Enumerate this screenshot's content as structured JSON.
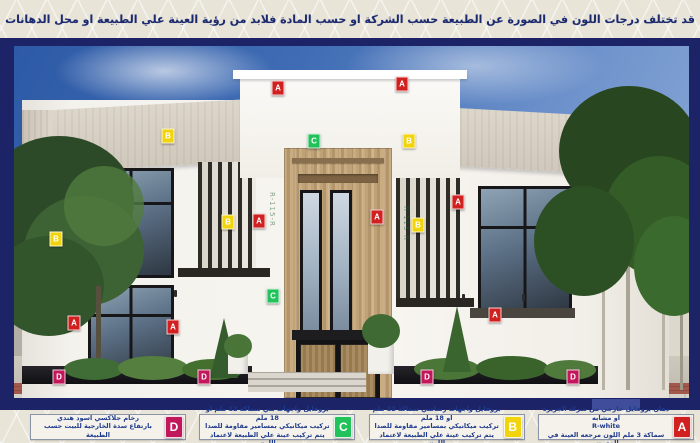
{
  "notice_bar": {
    "text": "قد تختلف درجات اللون في الصورة عن الطبيعة حسب الشركة او حسب المادة فلابد من رؤية العينة علي الطبيعة او محل الدهانات"
  },
  "colors": {
    "frame_navy": "#1d2367",
    "background_beige": "#e9e4d8",
    "marker_a_red": "#d02020",
    "marker_b_yellow": "#f2d40c",
    "marker_c_green": "#22c25a",
    "marker_d_magenta": "#c2185b"
  },
  "marker_styles": {
    "A": "#d02020",
    "B": "#f2d40c",
    "C": "#22c25a",
    "D": "#c2185b"
  },
  "markers": [
    {
      "letter": "A",
      "x": 278,
      "y": 88
    },
    {
      "letter": "A",
      "x": 402,
      "y": 84
    },
    {
      "letter": "B",
      "x": 168,
      "y": 136
    },
    {
      "letter": "C",
      "x": 314,
      "y": 141
    },
    {
      "letter": "B",
      "x": 409,
      "y": 141
    },
    {
      "letter": "A",
      "x": 458,
      "y": 202
    },
    {
      "letter": "A",
      "x": 377,
      "y": 217
    },
    {
      "letter": "B",
      "x": 418,
      "y": 225
    },
    {
      "letter": "A",
      "x": 259,
      "y": 221
    },
    {
      "letter": "B",
      "x": 228,
      "y": 222
    },
    {
      "letter": "B",
      "x": 56,
      "y": 239
    },
    {
      "letter": "A",
      "x": 74,
      "y": 323
    },
    {
      "letter": "A",
      "x": 173,
      "y": 327
    },
    {
      "letter": "C",
      "x": 273,
      "y": 296
    },
    {
      "letter": "A",
      "x": 495,
      "y": 315
    },
    {
      "letter": "D",
      "x": 59,
      "y": 377
    },
    {
      "letter": "D",
      "x": 204,
      "y": 377
    },
    {
      "letter": "D",
      "x": 427,
      "y": 377
    },
    {
      "letter": "D",
      "x": 573,
      "y": 377
    }
  ],
  "legend": [
    {
      "letter": "D",
      "chip_color": "#c2185b",
      "lines": [
        "رخام جلاكسي اسود هندي",
        "بارتفاع سدة الخارجية للبيت حسب الطبيعة"
      ]
    },
    {
      "letter": "C",
      "chip_color": "#22c25a",
      "lines": [
        "بروفايل واجهات بني سماكة 12 ملم او 18 ملم",
        "تركيب ميكانيكي بمسامير مقاومة للصدا",
        "يتم تركيب عينة علي الطبيعة لاعتماد اللون"
      ]
    },
    {
      "letter": "B",
      "chip_color": "#f2d40c",
      "lines": [
        "بروفايل واجهات رصاصي سماكة 12 ملم او 18 ملم",
        "تركيب ميكانيكي بمسامير مقاومة للصدا",
        "يتم تركيب عينة علي الطبيعة لاعتماد اللون"
      ]
    },
    {
      "letter": "A",
      "chip_color": "#d02020",
      "lines": [
        "دهان بروفايل خارجي من شركة الجزيرة او مشابه",
        "R-white",
        "سماكة 3 ملم اللون مرجعه العينة في المعرض"
      ]
    }
  ],
  "watermark": {
    "text": "R-115-R"
  }
}
